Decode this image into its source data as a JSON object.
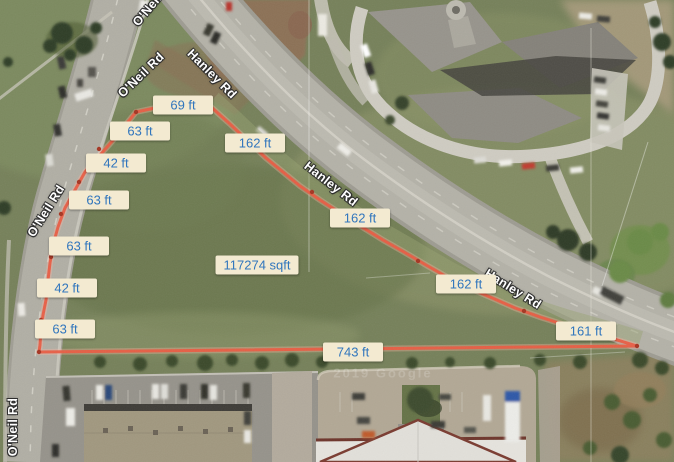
{
  "map": {
    "road_labels": [
      {
        "text": "O'Neil Rd",
        "x": 141,
        "y": 75,
        "rotation": -44
      },
      {
        "text": "Hanley Rd",
        "x": 212,
        "y": 74,
        "rotation": 45
      },
      {
        "text": "O'Neil Rd",
        "x": 46,
        "y": 211,
        "rotation": -58
      },
      {
        "text": "Hanley Rd",
        "x": 331,
        "y": 184,
        "rotation": 38
      },
      {
        "text": "Hanley Rd",
        "x": 513,
        "y": 289,
        "rotation": 32
      },
      {
        "text": "O'Neil Rd",
        "x": 13,
        "y": 427,
        "rotation": -90
      },
      {
        "text": "O'Neil Rd",
        "x": 154,
        "y": 2,
        "rotation": -50
      }
    ],
    "measurement": {
      "segments": [
        {
          "text": "69 ft",
          "x": 183,
          "y": 105
        },
        {
          "text": "63 ft",
          "x": 140,
          "y": 131
        },
        {
          "text": "162 ft",
          "x": 255,
          "y": 143
        },
        {
          "text": "42 ft",
          "x": 116,
          "y": 163
        },
        {
          "text": "63 ft",
          "x": 99,
          "y": 200
        },
        {
          "text": "63 ft",
          "x": 79,
          "y": 246
        },
        {
          "text": "162 ft",
          "x": 360,
          "y": 218
        },
        {
          "text": "42 ft",
          "x": 67,
          "y": 288
        },
        {
          "text": "162 ft",
          "x": 466,
          "y": 284
        },
        {
          "text": "63 ft",
          "x": 65,
          "y": 329
        },
        {
          "text": "161 ft",
          "x": 586,
          "y": 331
        },
        {
          "text": "743 ft",
          "x": 353,
          "y": 352
        }
      ],
      "area": {
        "text": "117274 sqft",
        "x": 257,
        "y": 265
      },
      "style": {
        "label_bg": "#f3ead1",
        "label_color": "#3176bd",
        "line_color": "#e95c42"
      }
    },
    "watermark": {
      "text": "2019 Google",
      "x": 383,
      "y": 373
    }
  }
}
